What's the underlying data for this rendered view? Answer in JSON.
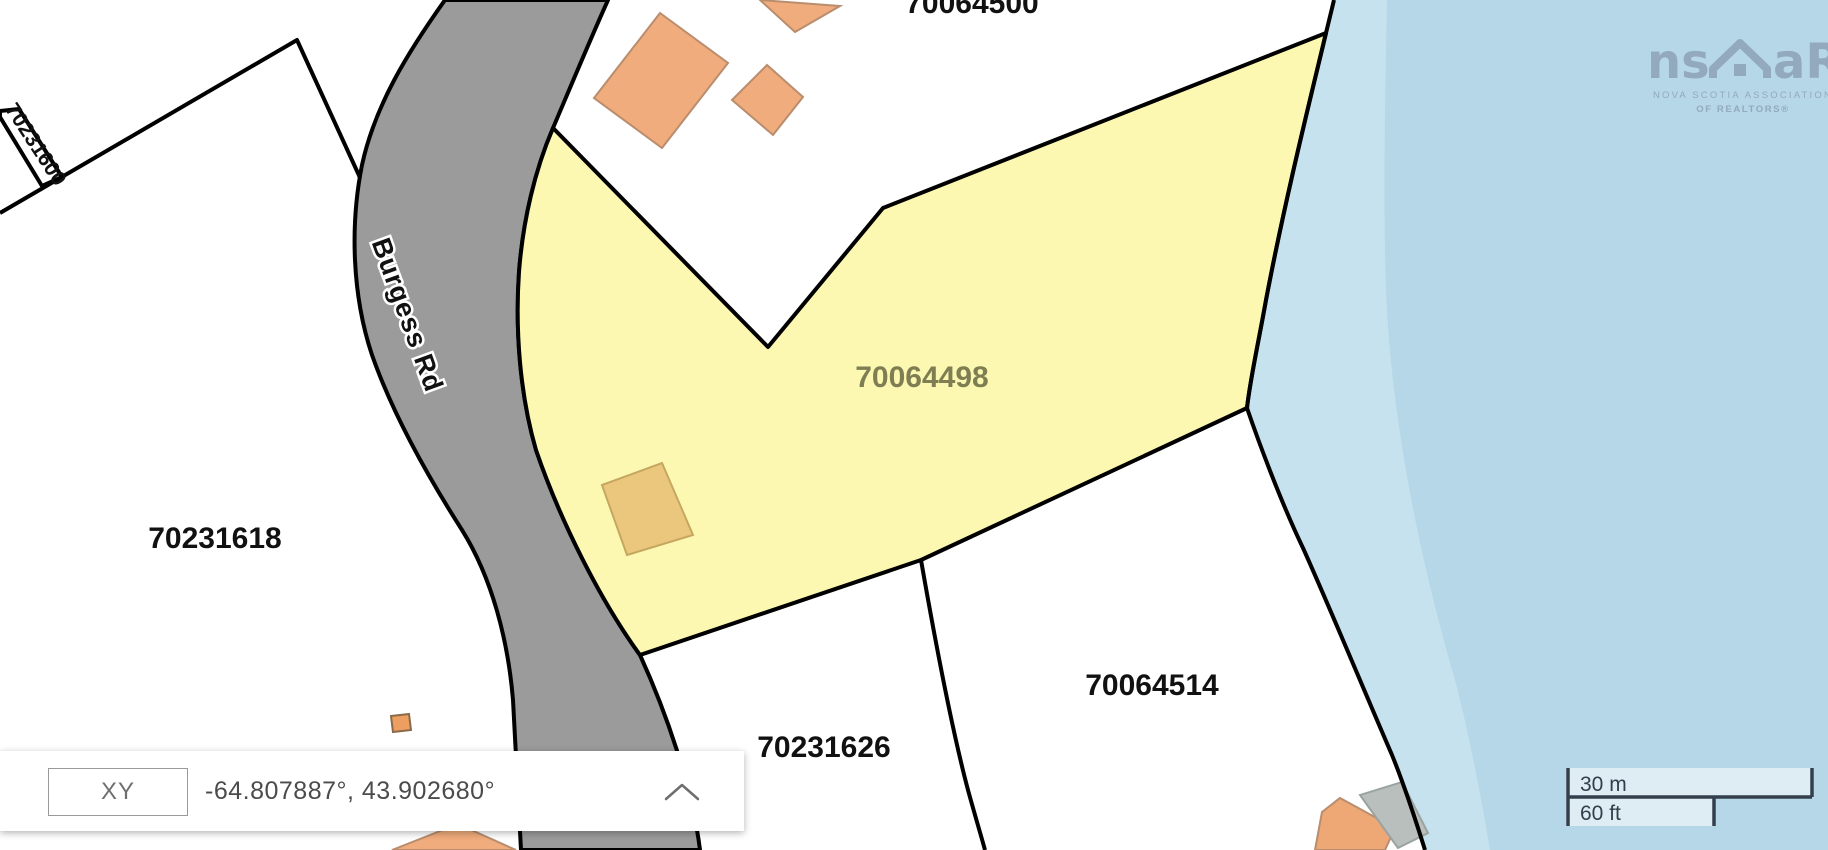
{
  "map": {
    "road": {
      "name": "Burgess Rd"
    },
    "parcels": {
      "highlighted": {
        "id": "70064498"
      },
      "west": {
        "id": "70231618"
      },
      "south": {
        "id": "70231626"
      },
      "southeast": {
        "id": "70064514"
      },
      "strip": {
        "id": "70231600"
      },
      "north": {
        "id": "70064500"
      }
    }
  },
  "coordinate_panel": {
    "mode_label": "XY",
    "value": "-64.807887°, 43.902680°"
  },
  "scale_bar": {
    "metric": "30 m",
    "imperial": "60 ft"
  },
  "logo": {
    "brand_left": "ns",
    "brand_right": "aR",
    "line1": "NOVA SCOTIA ASSOCIATION",
    "line2": "OF REALTORS®"
  },
  "colors": {
    "road_fill": "#9b9b9b",
    "parcel_highlight": "#fcf8b2",
    "parcel_highlight_label": "#7e7e52",
    "water": "#c6e2ef",
    "water_deep": "#b6d7e7",
    "building_orange": "#f0ac7c",
    "building_tan": "#ebc77e",
    "building_gray": "#b9bfbd",
    "boundary": "#000000",
    "scale_bar": "#33404c",
    "logo": "#93a9bc",
    "land": "#ffffff"
  }
}
